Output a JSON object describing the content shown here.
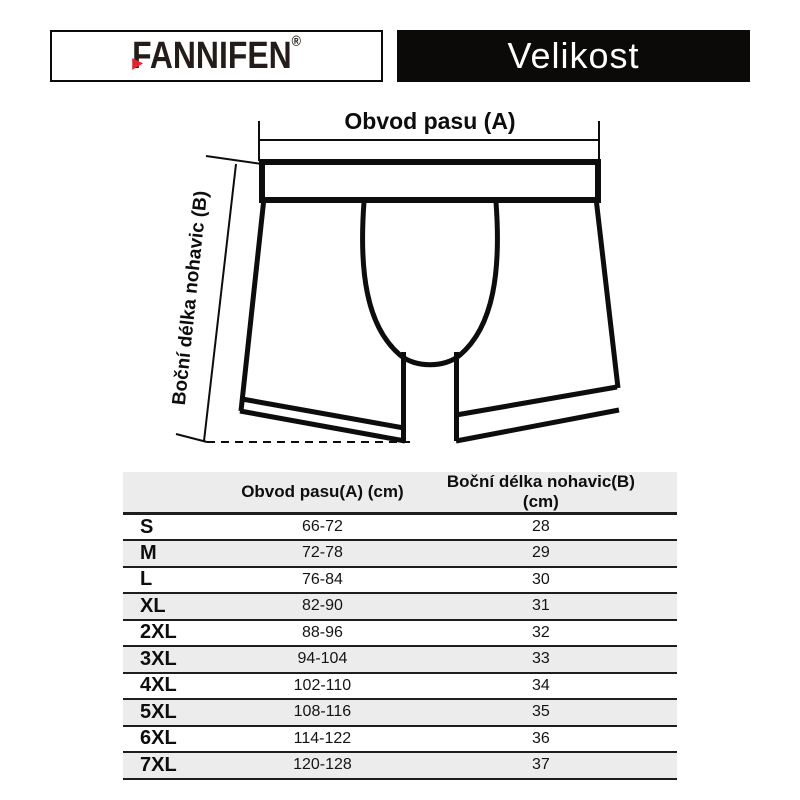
{
  "header": {
    "brand_name": "FANNIFEN",
    "brand_reg": "®",
    "title": "Velikost"
  },
  "diagram": {
    "waist_label": "Obvod pasu (A)",
    "length_label": "Boční délka nohavic (B)"
  },
  "table": {
    "headers": [
      "",
      "Obvod pasu(A) (cm)",
      "Boční délka nohavic(B) (cm)"
    ],
    "rows": [
      {
        "size": "S",
        "waist": "66-72",
        "length": "28"
      },
      {
        "size": "M",
        "waist": "72-78",
        "length": "29"
      },
      {
        "size": "L",
        "waist": "76-84",
        "length": "30"
      },
      {
        "size": "XL",
        "waist": "82-90",
        "length": "31"
      },
      {
        "size": "2XL",
        "waist": "88-96",
        "length": "32"
      },
      {
        "size": "3XL",
        "waist": "94-104",
        "length": "33"
      },
      {
        "size": "4XL",
        "waist": "102-110",
        "length": "34"
      },
      {
        "size": "5XL",
        "waist": "108-116",
        "length": "35"
      },
      {
        "size": "6XL",
        "waist": "114-122",
        "length": "36"
      },
      {
        "size": "7XL",
        "waist": "120-128",
        "length": "37"
      }
    ]
  },
  "colors": {
    "accent_red": "#e8212e",
    "title_bar_bg": "#0c0a08",
    "row_alt_bg": "#ececec",
    "line_color": "#1e1e1e",
    "drawing_color": "#0d0d0d"
  },
  "chart_data": {
    "type": "table",
    "title": "Velikost",
    "columns": [
      "Size",
      "Obvod pasu(A) (cm)",
      "Boční délka nohavic(B) (cm)"
    ],
    "rows": [
      [
        "S",
        "66-72",
        28
      ],
      [
        "M",
        "72-78",
        29
      ],
      [
        "L",
        "76-84",
        30
      ],
      [
        "XL",
        "82-90",
        31
      ],
      [
        "2XL",
        "88-96",
        32
      ],
      [
        "3XL",
        "94-104",
        33
      ],
      [
        "4XL",
        "102-110",
        34
      ],
      [
        "5XL",
        "108-116",
        35
      ],
      [
        "6XL",
        "114-122",
        36
      ],
      [
        "7XL",
        "120-128",
        37
      ]
    ],
    "notes": "A = waist circumference range in cm; B = side leg length in cm"
  }
}
